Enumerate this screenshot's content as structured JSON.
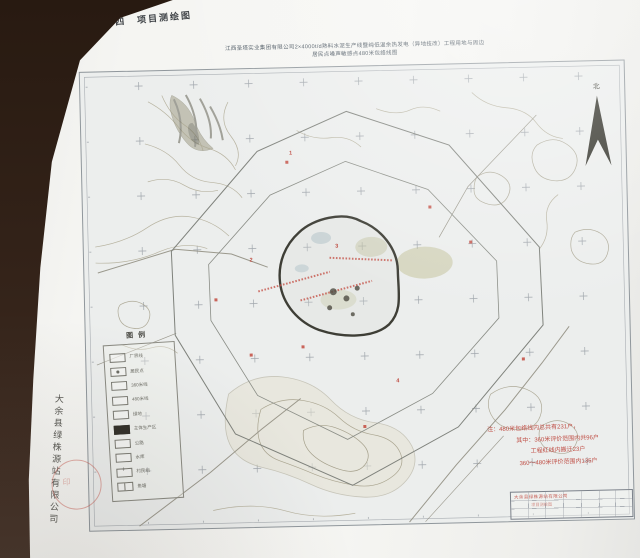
{
  "page": {
    "caption": "附图十四　项目测绘图",
    "side_company": "大余县绿株源站有限公司"
  },
  "drawing": {
    "title_line1": "江西圣塔实业集团有限公司2×4000t/d熟料水泥生产线暨纯低温余热发电（异地技改）工程用地与周边",
    "title_line2": "居民点噪声敏感点480米包络线图",
    "north_label": "北",
    "legend": {
      "title": "图例",
      "items": [
        {
          "label": "厂界线"
        },
        {
          "label": "居民点"
        },
        {
          "label": "360米线"
        },
        {
          "label": "480米线"
        },
        {
          "label": "绿地"
        },
        {
          "label": "主体生产区"
        },
        {
          "label": "公路"
        },
        {
          "label": "水库"
        },
        {
          "label": "村民组"
        },
        {
          "label": "鱼塘"
        }
      ]
    },
    "note_lines": [
      "注：480米包络线内总共有231户，",
      "其中：360米评价范围内共96户",
      "工程红线内搬迁23户",
      "360～480米评价范围内135户"
    ],
    "markers": [
      "1",
      "2",
      "3",
      "4"
    ],
    "title_block": {
      "stamp_text": "大余县绿株源站有限公司",
      "stamp_text2": "项目测绘图"
    },
    "colors": {
      "paper": "#f5f5f2",
      "table_brown": "#32211a",
      "annotation_red": "#ba382e",
      "ink": "#3f4347"
    }
  }
}
